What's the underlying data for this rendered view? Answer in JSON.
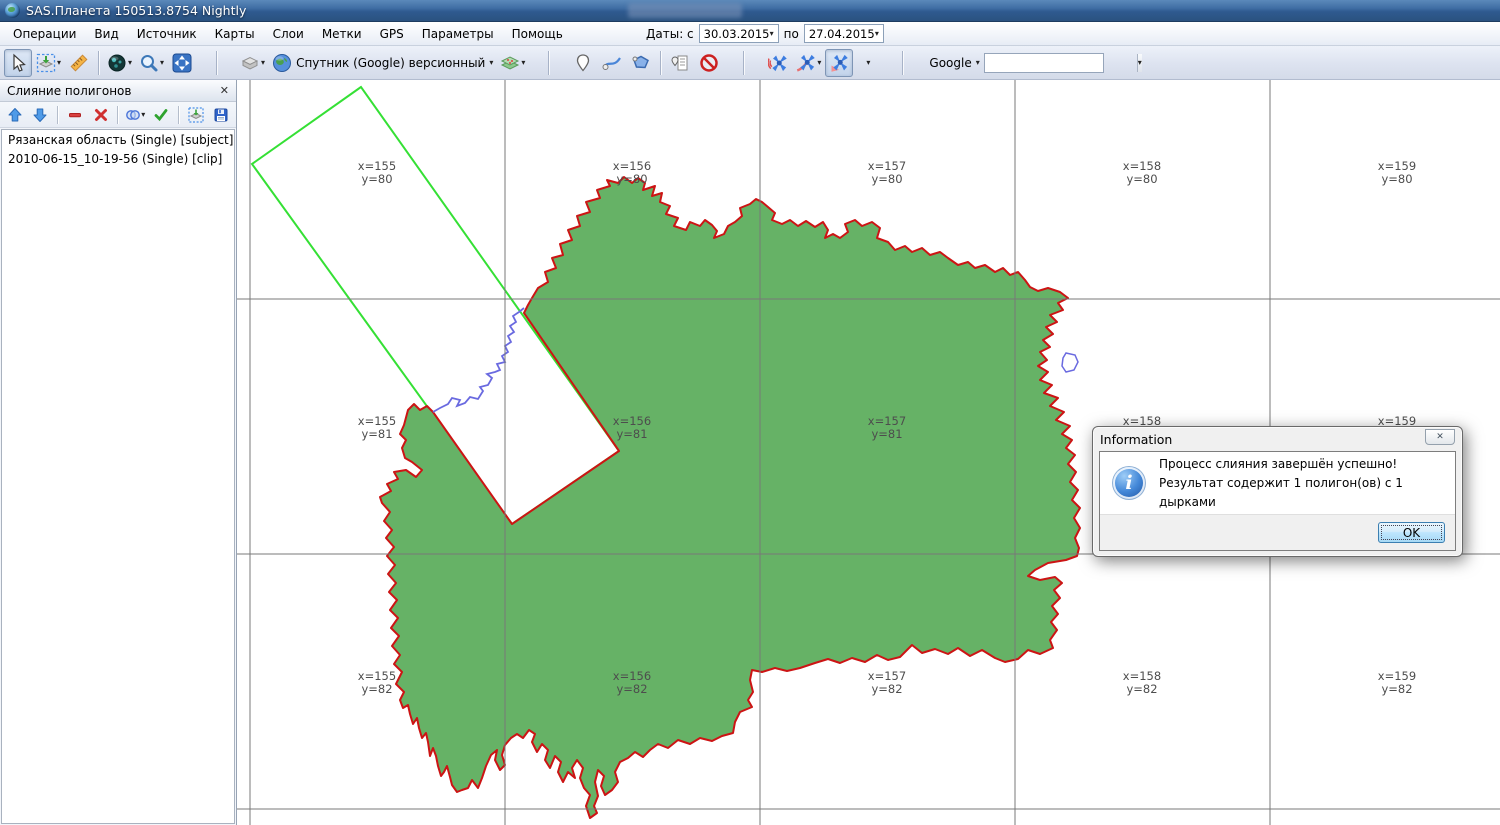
{
  "window": {
    "title": "SAS.Планета 150513.8754 Nightly"
  },
  "menubar": {
    "items": [
      "Операции",
      "Вид",
      "Источник",
      "Карты",
      "Слои",
      "Метки",
      "GPS",
      "Параметры",
      "Помощь"
    ]
  },
  "dates": {
    "label": "Даты: с",
    "from": "30.03.2015",
    "between": "по",
    "to": "27.04.2015"
  },
  "toolbar": {
    "map_source_label": "Спутник (Google) версионный",
    "search_provider": "Google",
    "search_value": ""
  },
  "panel": {
    "title": "Слияние полигонов",
    "items": [
      "Рязанская область (Single) [subject]",
      "2010-06-15_10-19-56 (Single) [clip]"
    ]
  },
  "map": {
    "grid": {
      "v_lines": [
        250,
        505,
        760,
        1015,
        1270
      ],
      "h_lines": [
        299,
        554,
        809
      ],
      "col_centers": [
        377,
        632,
        887,
        1142,
        1397
      ],
      "row_centers": [
        172,
        427,
        682
      ],
      "x_labels": [
        "x=155",
        "x=156",
        "x=157",
        "x=158",
        "x=159"
      ],
      "y_labels": [
        "y=80",
        "y=81",
        "y=82"
      ]
    },
    "colors": {
      "region_fill": "#66b266",
      "region_border": "#cc1414",
      "selection_rect": "#35e035",
      "river": "#6a6ae0",
      "grid_line": "#787878"
    }
  },
  "dialog": {
    "title": "Information",
    "message_line1": "Процесс слияния завершён успешно!",
    "message_line2": "Результат содержит 1 полигон(ов) с 1 дырками",
    "ok_label": "OK"
  },
  "icons": {
    "caret": "▾",
    "close": "✕"
  }
}
